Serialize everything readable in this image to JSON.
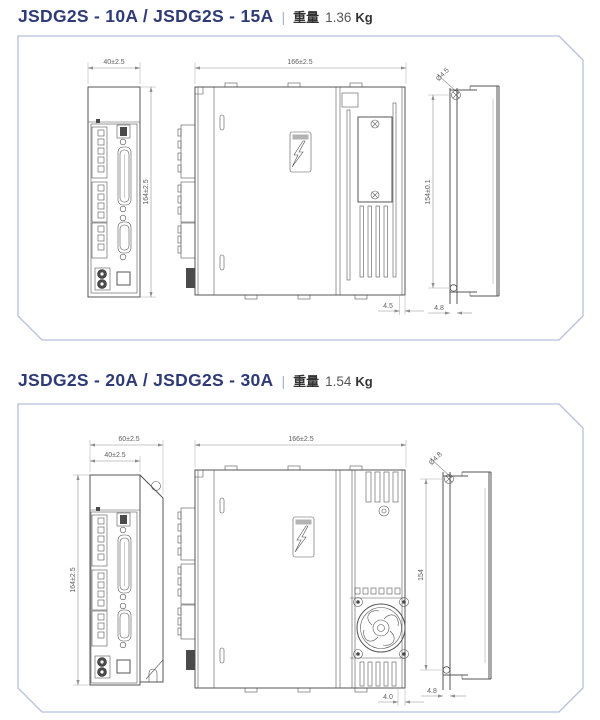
{
  "colors": {
    "accent_title": "#2e3b78",
    "panel_border": "#b6c0da",
    "drawing_line": "#555555",
    "dimension_line": "#8f8f8f"
  },
  "sections": [
    {
      "title": "JSDG2S - 10A / JSDG2S - 15A",
      "separator": "|",
      "weight_label": "重量",
      "weight_value": "1.36",
      "weight_unit": "Kg",
      "dims": {
        "front_width": "40±2.5",
        "front_height": "164±2.5",
        "side_width": "166±2.5",
        "side_gap": "4.5",
        "hole_dia": "Ø4.5",
        "mount_pitch": "154±0.1",
        "slot_width": "4.8"
      }
    },
    {
      "title": "JSDG2S - 20A / JSDG2S - 30A",
      "separator": "|",
      "weight_label": "重量",
      "weight_value": "1.54",
      "weight_unit": "Kg",
      "dims": {
        "front_outer_width": "60±2.5",
        "front_width": "40±2.5",
        "front_height": "164±2.5",
        "side_width": "166±2.5",
        "side_gap": "4.0",
        "hole_dia": "Ø4.8",
        "mount_pitch": "154",
        "slot_width": "4.8"
      }
    }
  ]
}
